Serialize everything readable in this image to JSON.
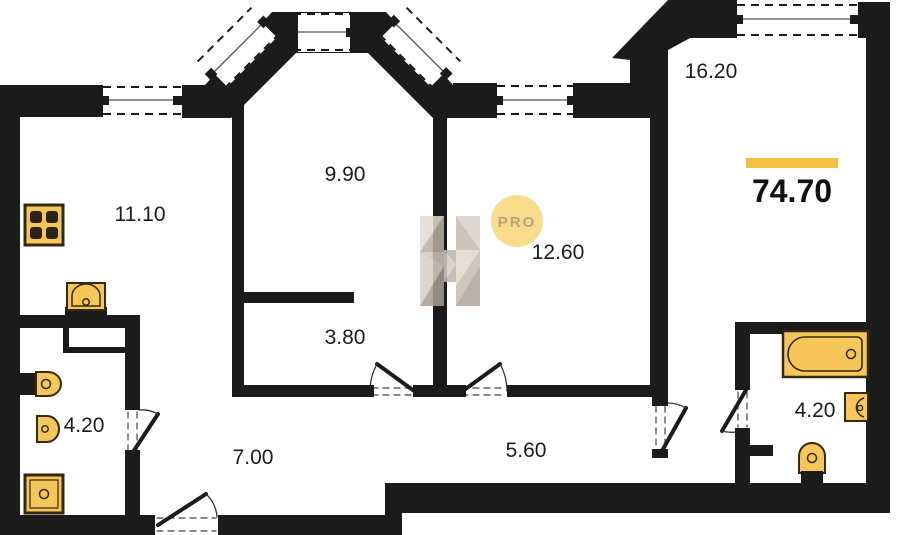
{
  "plan": {
    "title": "apartment-floor-plan",
    "total_area": "74.70",
    "rooms": {
      "kitchen": "11.10",
      "living": "9.90",
      "bedroom": "12.60",
      "master": "16.20",
      "inner_hall": "3.80",
      "bath_left": "4.20",
      "hallway": "7.00",
      "corridor": "5.60",
      "bath_right": "4.20"
    },
    "logo": {
      "text": "PRO"
    },
    "colors": {
      "wall": "#1b1b1b",
      "fixture_fill": "#F7C65A",
      "fixture_stroke": "#33290f",
      "accent_bar": "#F2C043",
      "logo_circle": "#F8DC8C",
      "logo_text": "#B3A67E",
      "watermark": "#C9BEB2"
    }
  }
}
